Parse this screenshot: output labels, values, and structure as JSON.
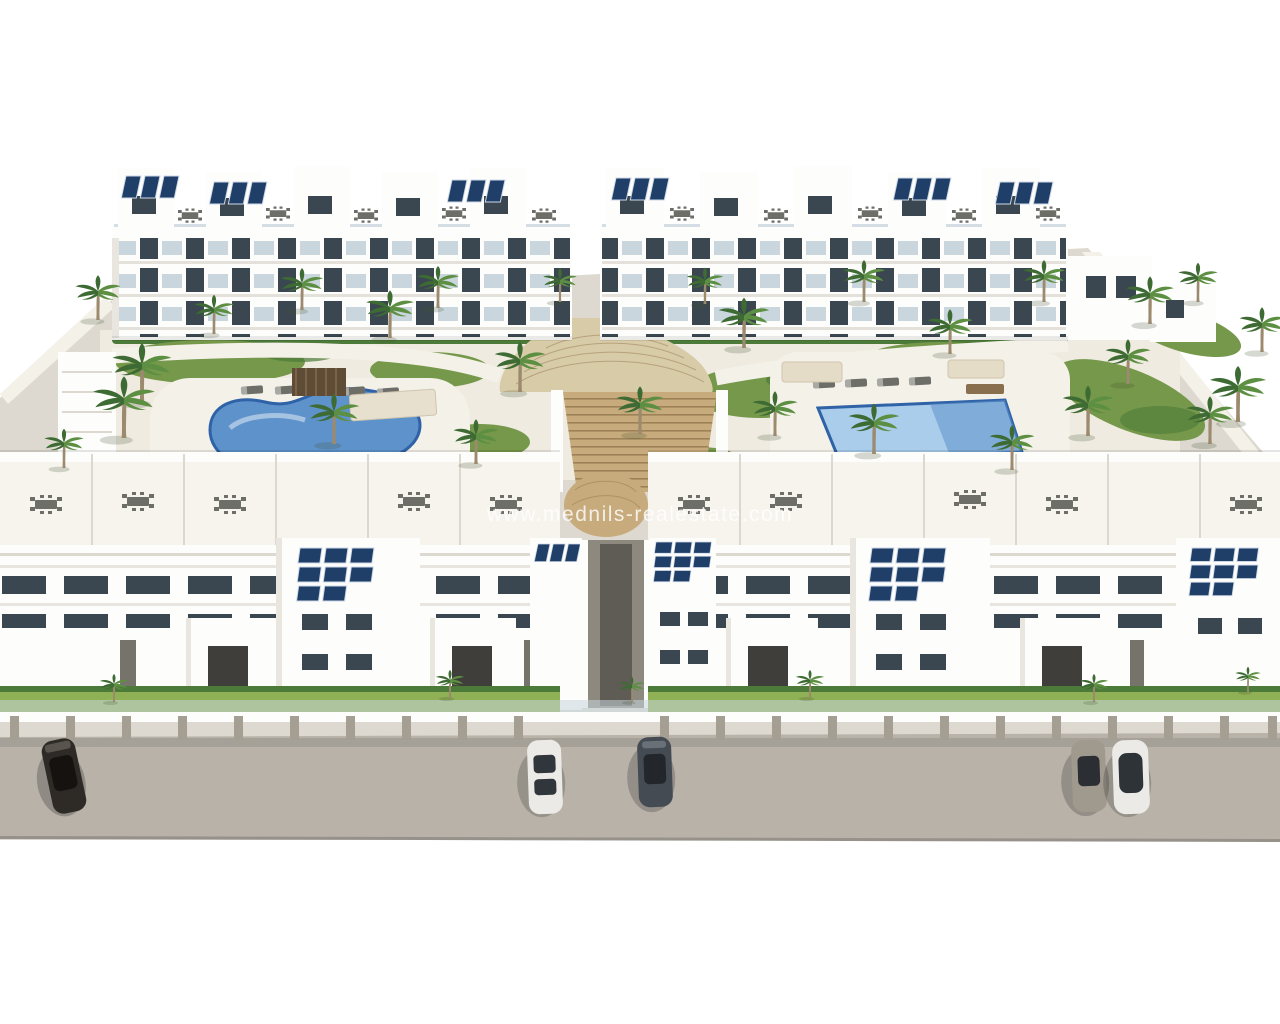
{
  "image": {
    "title": "Aerial 3D architectural rendering of a new-build white apartment complex",
    "watermark": "www.mednils-realestate.com",
    "objects": {
      "apartment_blocks": 4,
      "swimming_pools": 2,
      "pool_left_shape": "freeform kidney",
      "pool_right_shape": "rectangular",
      "central_staircase": 1,
      "palm_trees": 34,
      "parked_cars": 5,
      "rooftop_solar_arrays": 11,
      "rooftop_dining_sets": 20,
      "sun_loungers": 9
    },
    "colors": {
      "background": "#ffffff",
      "ground": "#ddd9d0",
      "deck": "#efebe1",
      "deck_light": "#f4f1e9",
      "terrace": "#f7f4ee",
      "road": "#b8b2a9",
      "building": "#fdfdfc",
      "building_shade": "#e9e6e0",
      "window": "#3a4750",
      "glass": "#c9d6dd",
      "lawn": "#75984a",
      "lawn_bright": "#8fb054",
      "hedge": "#4c7a38",
      "pool_left": "#5e92cb",
      "pool_right": "#a9cdea",
      "pool_rim": "#2f62a6",
      "stairs": "#c7ab7c",
      "stairs_light": "#d8cba8",
      "stair_line": "#9d8257",
      "solar": "#1f3f69",
      "palm": "#3e6b33",
      "palm_light": "#5d8f43",
      "palm_trunk": "#9b8a6d",
      "furniture": "#6e6e68",
      "pillar": "#a49e93",
      "car_dark": "#2e2a26",
      "car_white": "#eceae6",
      "car_gray": "#454b52",
      "car_beige": "#a09a8e",
      "watermark": "#ffffff"
    }
  }
}
